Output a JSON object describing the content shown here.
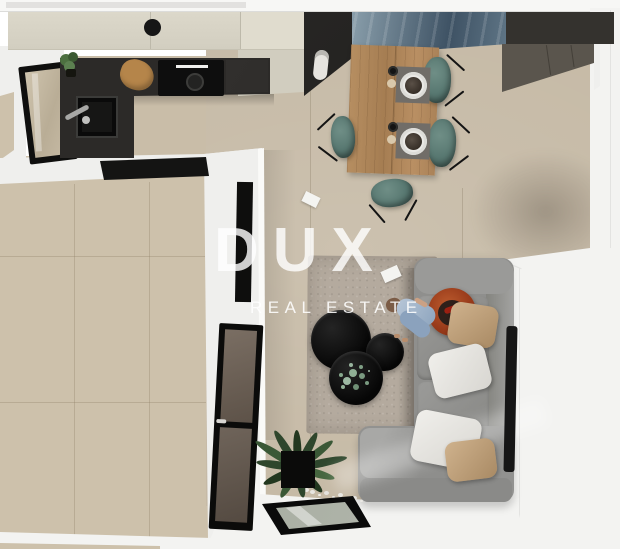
{
  "watermark": {
    "title": "DUX",
    "subtitle": "REAL ESTATE"
  },
  "scene": {
    "type": "top-down apartment 3d render",
    "rooms": [
      "kitchen",
      "dining-area",
      "living-room",
      "hallway",
      "empty-tiled-room"
    ],
    "furniture": [
      "kitchen-cabinets",
      "kitchen-counter",
      "sink",
      "cooktop",
      "cutting-board",
      "tall-black-cabinet",
      "coffee-machine",
      "marble-runner",
      "gray-sideboard",
      "dining-table",
      "dining-chair",
      "placemat-setting",
      "sofa",
      "pillows",
      "orange-armchair",
      "person",
      "coffee-tables",
      "rug",
      "tv",
      "glass-door",
      "glass-partition",
      "floor-plant",
      "glass-floor-panel",
      "pebble-decor",
      "window"
    ]
  },
  "palette": {
    "bg": "#ffffff",
    "wall": "#efefed",
    "wall-bright": "#f3f3f1",
    "hallway": "#f3f3f1",
    "floor-left": "#cdc1ab",
    "floor-right": "#c6baa6",
    "floor-kitchen": "#c9bda8",
    "counter": "#2c2a28",
    "cabinet-cream": "#d9d5c7",
    "cabinet-gray-top": "#34322e",
    "cabinet-gray-face": "#5a554d",
    "marble-dark": "#46596b",
    "marble-light": "#90a5b1",
    "wood": "#b3895c",
    "chair-teal": "#5f807a",
    "placemat": "#716d68",
    "sofa": "#8f8f8d",
    "pillow-tan": "#c2a47f",
    "pillow-white": "#eae8e4",
    "rug": "#b4aa9e",
    "coffee-table": "#0d0d0d",
    "orange-chair": "#a4431f",
    "dress-blue": "#a9bcce",
    "plant-dark": "#2e462c",
    "plant-light": "#86a88c",
    "glass-door": "#6f645a",
    "glass-floor": "#b7bcb1",
    "watermark": "#ffffff"
  }
}
